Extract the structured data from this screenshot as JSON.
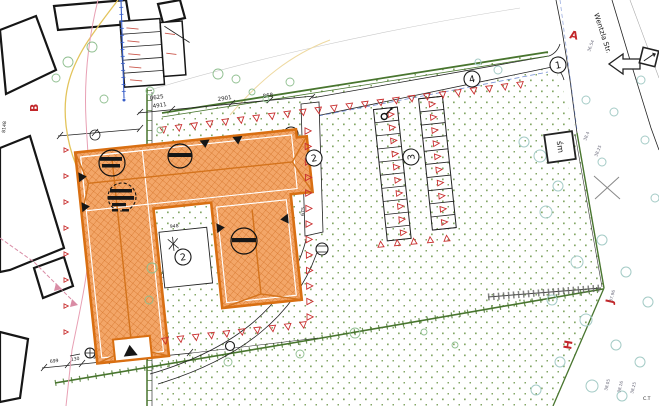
{
  "plan": {
    "survey_letters": {
      "a": "A",
      "b": "B",
      "h": "H",
      "j": "J"
    },
    "surface_labels": {
      "n1": "1",
      "n2_walk": "2",
      "n2_terrace": "2",
      "n3": "3",
      "n4": "4"
    },
    "street_name": "Wentzla Str.",
    "bin_shed_label": "śm",
    "corner_note": "C.T",
    "dimensions": {
      "top_a": "0625",
      "top_a2": "4911",
      "top_b": "2901",
      "top_c": "868",
      "bottom_a": "699",
      "bottom_b": "130",
      "bottom_c": "944",
      "bottom_d": "944",
      "courtyard": "948",
      "left_a": "3937",
      "left_b": "8148",
      "walk": "675",
      "south": "770",
      "east": "1290",
      "block": "41.5"
    },
    "elevations": {
      "e1": "38.4",
      "e2": "38.25",
      "e3": "37.96",
      "e4": "38.05",
      "e5": "38.16",
      "e6": "38.25",
      "e7": "36.54"
    }
  },
  "colors": {
    "building_fill": "#f3a668",
    "building_hatch": "#d4732a",
    "building_outline": "#d96f12",
    "fence_red": "#c92f2f",
    "hedge_green": "#48752e",
    "stipple_green": "#7da25f",
    "tree_teal": "#a4cbc6",
    "survey_red": "#c2272a"
  }
}
